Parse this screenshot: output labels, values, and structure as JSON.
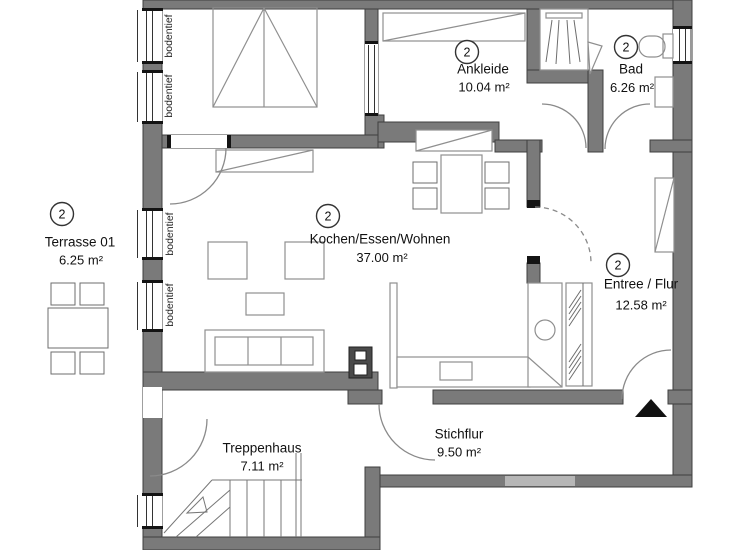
{
  "plan": {
    "rooms": [
      {
        "key": "terrasse",
        "badge": "2",
        "name": "Terrasse 01",
        "area": "6.25 m²"
      },
      {
        "key": "ankleide",
        "badge": "2",
        "name": "Ankleide",
        "area": "10.04 m²"
      },
      {
        "key": "bad",
        "badge": "2",
        "name": "Bad",
        "area": "6.26 m²"
      },
      {
        "key": "wohnen",
        "badge": "2",
        "name": "Kochen/Essen/Wohnen",
        "area": "37.00 m²"
      },
      {
        "key": "entree",
        "badge": "2",
        "name": "Entree / Flur",
        "area": "12.58 m²"
      },
      {
        "key": "treppenhaus",
        "name": "Treppenhaus",
        "area": "7.11 m²"
      },
      {
        "key": "stichflur",
        "name": "Stichflur",
        "area": "9.50 m²"
      }
    ],
    "window_label": "bodentief",
    "colors": {
      "wall": "#7a7a7a",
      "wall_light": "#b6b6b6",
      "outline": "#3f3f3f",
      "furniture": "#8f8f8f",
      "text": "#111111"
    }
  }
}
